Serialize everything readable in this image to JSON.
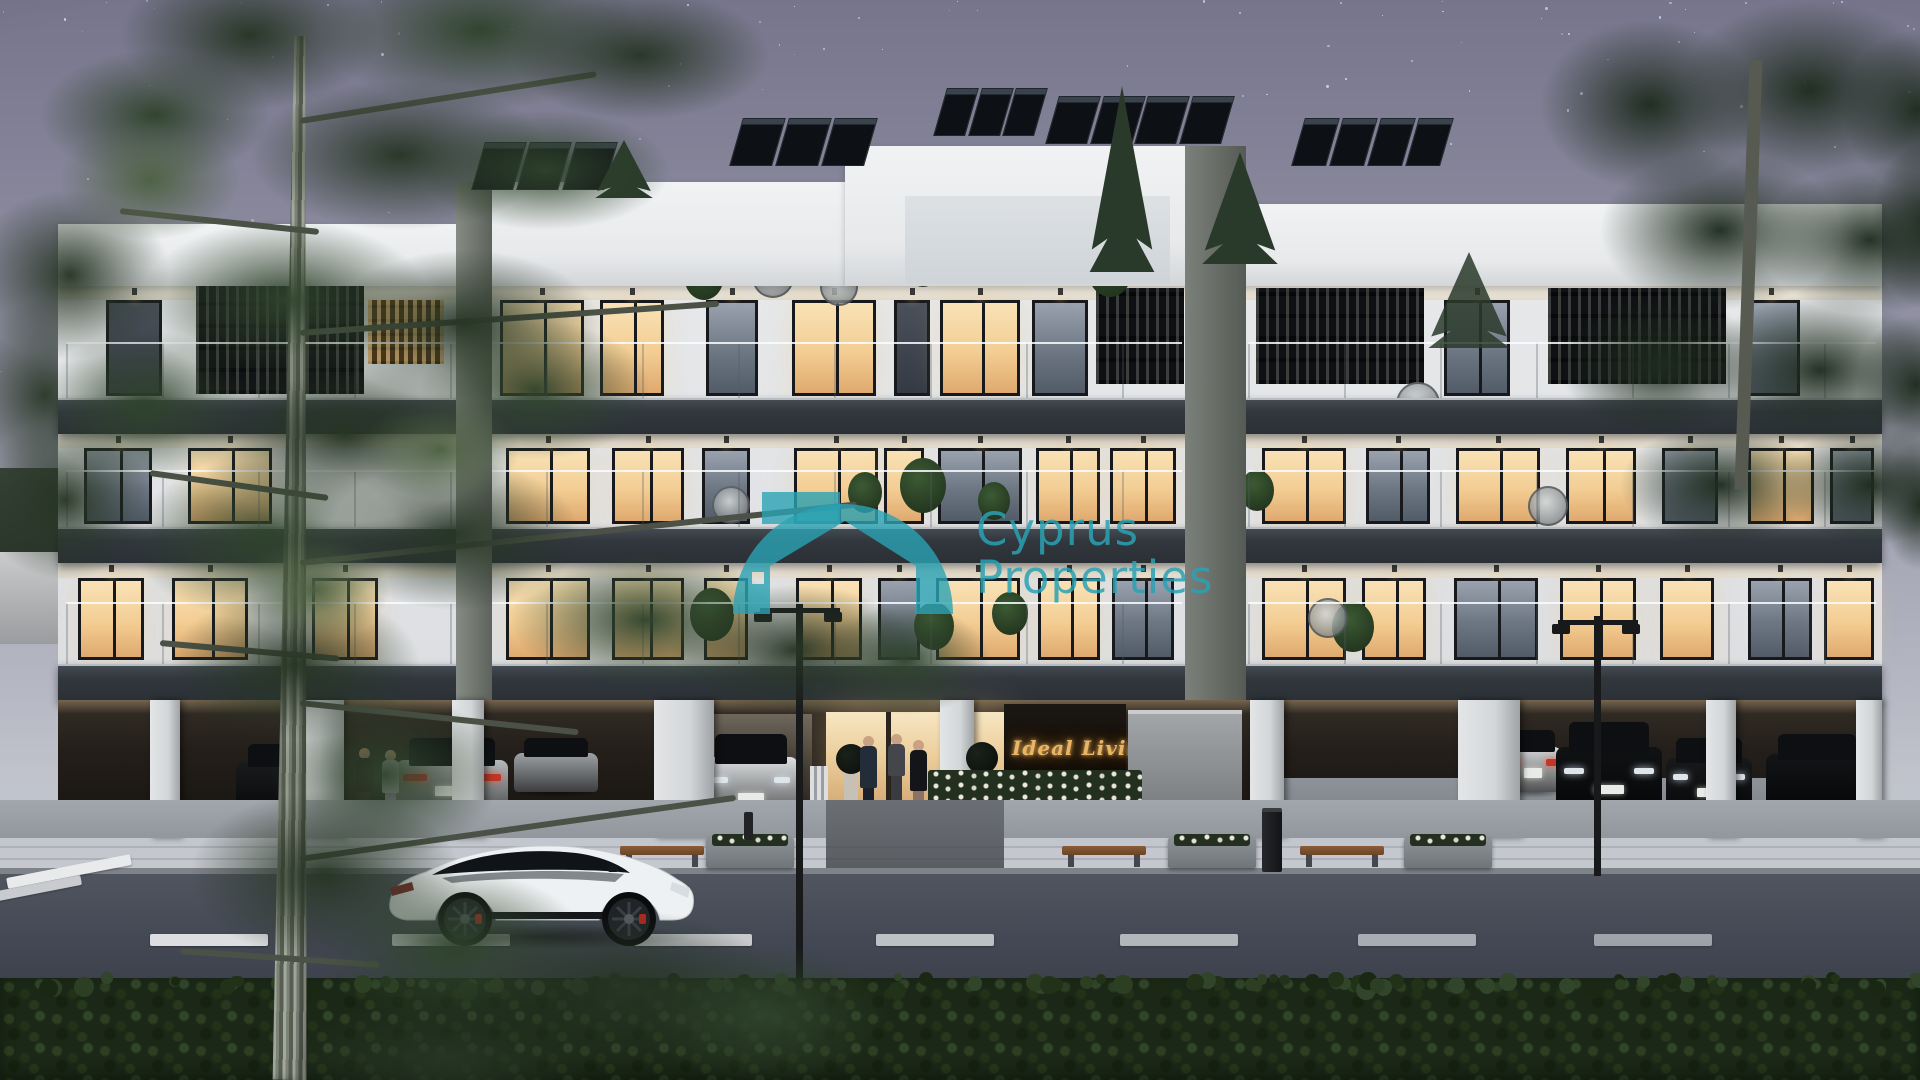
{
  "watermark": {
    "line1": "Cyprus",
    "line2": "Properties",
    "color": "#2aa2b4"
  },
  "entrance_sign": {
    "text": "Ideal Living 11",
    "color": "#eab566"
  },
  "scene": {
    "description": "dusk architectural render of modern 3-storey apartment building",
    "sky": {
      "star_color": "#d6e4ff",
      "star_count": 120
    },
    "building": {
      "floor_count": 3,
      "floors": [
        {
          "name": "top",
          "wallY": 284,
          "winY": 300,
          "winH": 96,
          "windows": [
            {
              "x": 106,
              "w": 56,
              "t": "dark"
            },
            {
              "x": 500,
              "w": 84,
              "t": "lit"
            },
            {
              "x": 600,
              "w": 64,
              "t": "lit"
            },
            {
              "x": 706,
              "w": 52,
              "t": "dim"
            },
            {
              "x": 792,
              "w": 84,
              "t": "lit"
            },
            {
              "x": 894,
              "w": 36,
              "t": "dark"
            },
            {
              "x": 940,
              "w": 80,
              "t": "lit"
            },
            {
              "x": 1032,
              "w": 56,
              "t": "dim"
            },
            {
              "x": 1444,
              "w": 66,
              "t": "dim"
            },
            {
              "x": 1742,
              "w": 58,
              "t": "dim"
            }
          ]
        },
        {
          "name": "mid",
          "wallY": 432,
          "winY": 448,
          "winH": 76,
          "windows": [
            {
              "x": 84,
              "w": 68,
              "t": "dim"
            },
            {
              "x": 188,
              "w": 84,
              "t": "lit"
            },
            {
              "x": 506,
              "w": 84,
              "t": "lit"
            },
            {
              "x": 612,
              "w": 72,
              "t": "lit"
            },
            {
              "x": 702,
              "w": 48,
              "t": "dim"
            },
            {
              "x": 794,
              "w": 84,
              "t": "lit"
            },
            {
              "x": 884,
              "w": 40,
              "t": "lit"
            },
            {
              "x": 938,
              "w": 84,
              "t": "dim"
            },
            {
              "x": 1036,
              "w": 64,
              "t": "lit"
            },
            {
              "x": 1110,
              "w": 66,
              "t": "lit"
            },
            {
              "x": 1262,
              "w": 84,
              "t": "lit"
            },
            {
              "x": 1366,
              "w": 64,
              "t": "dim"
            },
            {
              "x": 1456,
              "w": 84,
              "t": "lit"
            },
            {
              "x": 1566,
              "w": 70,
              "t": "lit"
            },
            {
              "x": 1662,
              "w": 56,
              "t": "dim"
            },
            {
              "x": 1748,
              "w": 66,
              "t": "lit"
            },
            {
              "x": 1830,
              "w": 44,
              "t": "dim"
            }
          ]
        },
        {
          "name": "first",
          "wallY": 561,
          "winY": 578,
          "winH": 82,
          "windows": [
            {
              "x": 78,
              "w": 66,
              "t": "lit"
            },
            {
              "x": 172,
              "w": 76,
              "t": "lit"
            },
            {
              "x": 312,
              "w": 66,
              "t": "lit"
            },
            {
              "x": 506,
              "w": 84,
              "t": "lit"
            },
            {
              "x": 612,
              "w": 72,
              "t": "lit"
            },
            {
              "x": 704,
              "w": 44,
              "t": "lit"
            },
            {
              "x": 796,
              "w": 66,
              "t": "lit"
            },
            {
              "x": 878,
              "w": 42,
              "t": "dim"
            },
            {
              "x": 936,
              "w": 84,
              "t": "lit"
            },
            {
              "x": 1038,
              "w": 62,
              "t": "lit"
            },
            {
              "x": 1112,
              "w": 62,
              "t": "dim"
            },
            {
              "x": 1262,
              "w": 84,
              "t": "lit"
            },
            {
              "x": 1362,
              "w": 64,
              "t": "lit"
            },
            {
              "x": 1454,
              "w": 84,
              "t": "dim"
            },
            {
              "x": 1560,
              "w": 76,
              "t": "lit"
            },
            {
              "x": 1660,
              "w": 54,
              "t": "lit"
            },
            {
              "x": 1748,
              "w": 64,
              "t": "dim"
            },
            {
              "x": 1824,
              "w": 50,
              "t": "lit"
            }
          ]
        }
      ],
      "screens": [
        {
          "x": 196,
          "y": 286,
          "w": 168,
          "h": 108,
          "type": "black"
        },
        {
          "x": 368,
          "y": 300,
          "w": 76,
          "h": 64,
          "type": "amber"
        },
        {
          "x": 1096,
          "y": 288,
          "w": 88,
          "h": 96,
          "type": "black"
        },
        {
          "x": 1256,
          "y": 288,
          "w": 168,
          "h": 96,
          "type": "black"
        },
        {
          "x": 1548,
          "y": 288,
          "w": 178,
          "h": 96,
          "type": "black"
        }
      ],
      "rails": [
        {
          "x": 66,
          "y": 342,
          "w": 1116,
          "h": 56
        },
        {
          "x": 1248,
          "y": 342,
          "w": 628,
          "h": 56
        },
        {
          "x": 66,
          "y": 470,
          "w": 1116,
          "h": 57
        },
        {
          "x": 1248,
          "y": 470,
          "w": 628,
          "h": 57
        },
        {
          "x": 66,
          "y": 602,
          "w": 1116,
          "h": 62
        },
        {
          "x": 1248,
          "y": 602,
          "w": 628,
          "h": 62
        },
        {
          "x": 905,
          "y": 240,
          "w": 265,
          "h": 42
        }
      ],
      "columns": [
        {
          "x": 150,
          "w": 30
        },
        {
          "x": 282,
          "w": 62
        },
        {
          "x": 452,
          "w": 32
        },
        {
          "x": 654,
          "w": 60
        },
        {
          "x": 940,
          "w": 34
        },
        {
          "x": 1250,
          "w": 34
        },
        {
          "x": 1458,
          "w": 62
        },
        {
          "x": 1706,
          "w": 30
        },
        {
          "x": 1856,
          "w": 26
        }
      ],
      "solar": [
        {
          "x": 478,
          "y": 142,
          "w": 136
        },
        {
          "x": 736,
          "y": 118,
          "w": 138
        },
        {
          "x": 940,
          "y": 88,
          "w": 104
        },
        {
          "x": 1052,
          "y": 96,
          "w": 178
        },
        {
          "x": 1298,
          "y": 118,
          "w": 152
        }
      ],
      "plants": [
        {
          "x": 684,
          "y": 252,
          "s": 40
        },
        {
          "x": 1088,
          "y": 244,
          "s": 44
        },
        {
          "x": 906,
          "y": 246,
          "s": 34
        },
        {
          "x": 848,
          "y": 472,
          "s": 34
        },
        {
          "x": 900,
          "y": 458,
          "s": 46
        },
        {
          "x": 978,
          "y": 482,
          "s": 32
        },
        {
          "x": 690,
          "y": 588,
          "s": 44
        },
        {
          "x": 914,
          "y": 602,
          "s": 40
        },
        {
          "x": 992,
          "y": 592,
          "s": 36
        },
        {
          "x": 1332,
          "y": 602,
          "s": 42
        },
        {
          "x": 1240,
          "y": 470,
          "s": 34
        }
      ],
      "egg_chairs": [
        {
          "x": 752,
          "y": 256,
          "s": 42
        },
        {
          "x": 820,
          "y": 268,
          "s": 38
        },
        {
          "x": 1396,
          "y": 382,
          "s": 44
        },
        {
          "x": 1528,
          "y": 486,
          "s": 40
        },
        {
          "x": 712,
          "y": 486,
          "s": 38
        },
        {
          "x": 1308,
          "y": 598,
          "s": 40
        }
      ]
    },
    "garage_cars": [
      {
        "x": 236,
        "y": 744,
        "w": 100,
        "h": 64,
        "kind": "side",
        "color": "#191b1d"
      },
      {
        "x": 396,
        "y": 738,
        "w": 112,
        "h": 78,
        "kind": "rear",
        "color": "#b6b9bb"
      },
      {
        "x": 514,
        "y": 738,
        "w": 84,
        "h": 54,
        "kind": "side",
        "color": "#9ea2a5"
      },
      {
        "x": 704,
        "y": 734,
        "w": 94,
        "h": 82,
        "kind": "front",
        "color": "#dde0e2"
      },
      {
        "x": 1504,
        "y": 730,
        "w": 58,
        "h": 62,
        "kind": "rear",
        "color": "#d5d7d9"
      },
      {
        "x": 1556,
        "y": 722,
        "w": 106,
        "h": 88,
        "kind": "front",
        "color": "#101214"
      },
      {
        "x": 1666,
        "y": 738,
        "w": 86,
        "h": 70,
        "kind": "front",
        "color": "#17191b"
      },
      {
        "x": 1766,
        "y": 734,
        "w": 102,
        "h": 72,
        "kind": "side",
        "color": "#121416"
      }
    ],
    "people": [
      {
        "x": 856,
        "y": 736,
        "h": 94,
        "top": "#232c39",
        "bottom": "#1a212c",
        "head": "#c9a183",
        "name": "man-at-entrance"
      },
      {
        "x": 884,
        "y": 734,
        "h": 70,
        "top": "#45464c",
        "bottom": "#3a3b41",
        "head": "#c9a183",
        "name": "woman-behind"
      },
      {
        "x": 906,
        "y": 740,
        "h": 92,
        "top": "#141519",
        "bottom": "#8a7264",
        "head": "#caa184",
        "name": "woman-at-entrance"
      },
      {
        "x": 352,
        "y": 748,
        "h": 76,
        "top": "#1d0f13",
        "bottom": "#2a1a1e",
        "head": "#b98a6d",
        "name": "woman-garage-1"
      },
      {
        "x": 378,
        "y": 750,
        "h": 74,
        "top": "#cdc6d2",
        "bottom": "#b08fc2",
        "head": "#c9a183",
        "name": "woman-garage-2"
      }
    ],
    "street": {
      "lane_dashes": {
        "y": 934,
        "h": 12,
        "w": 118,
        "xs": [
          150,
          392,
          634,
          876,
          1120,
          1358,
          1594
        ]
      },
      "benches": [
        620,
        1062,
        1300
      ],
      "planters": [
        706,
        1168,
        1404
      ],
      "lamps": [
        {
          "x": 796,
          "top": 604,
          "bottom": 988
        },
        {
          "x": 1594,
          "top": 616,
          "bottom": 876
        }
      ]
    }
  }
}
